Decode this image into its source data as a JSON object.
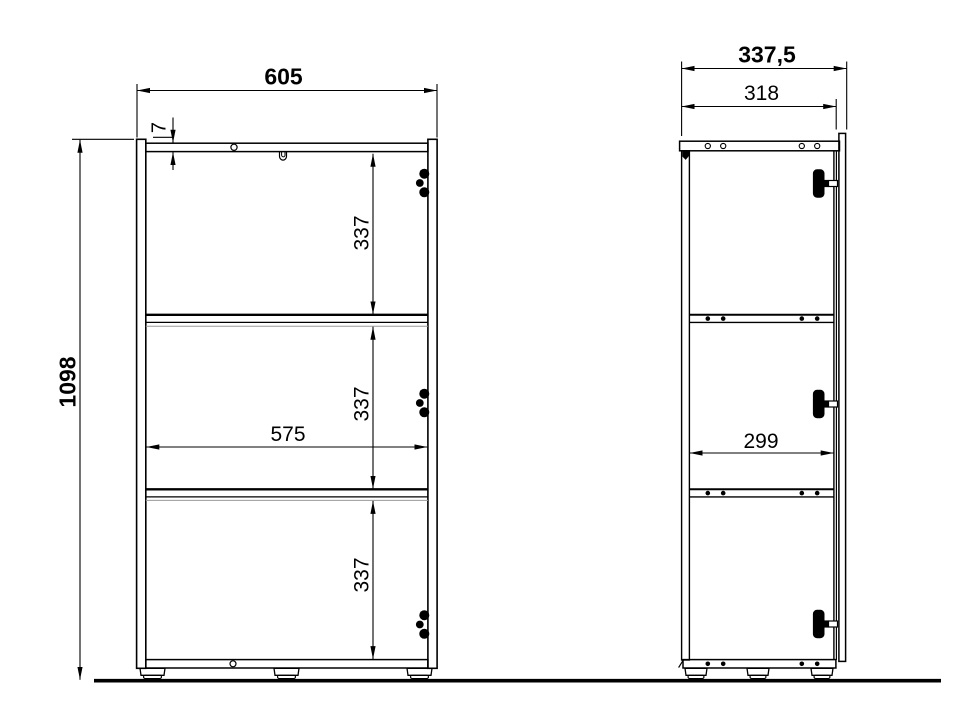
{
  "drawing": {
    "kind": "furniture cabinet technical drawing, front and side elevation",
    "background_color": "#ffffff",
    "line_color": "#000000",
    "front_view": {
      "overall_width_mm": "605",
      "overall_height_mm": "1098",
      "top_panel_thickness_mm": "7",
      "inner_width_mm": "575",
      "compartment_heights_mm": [
        "337",
        "337",
        "337"
      ]
    },
    "side_view": {
      "overall_depth_mm": "337,5",
      "body_depth_mm": "318",
      "inner_depth_mm": "299"
    }
  }
}
